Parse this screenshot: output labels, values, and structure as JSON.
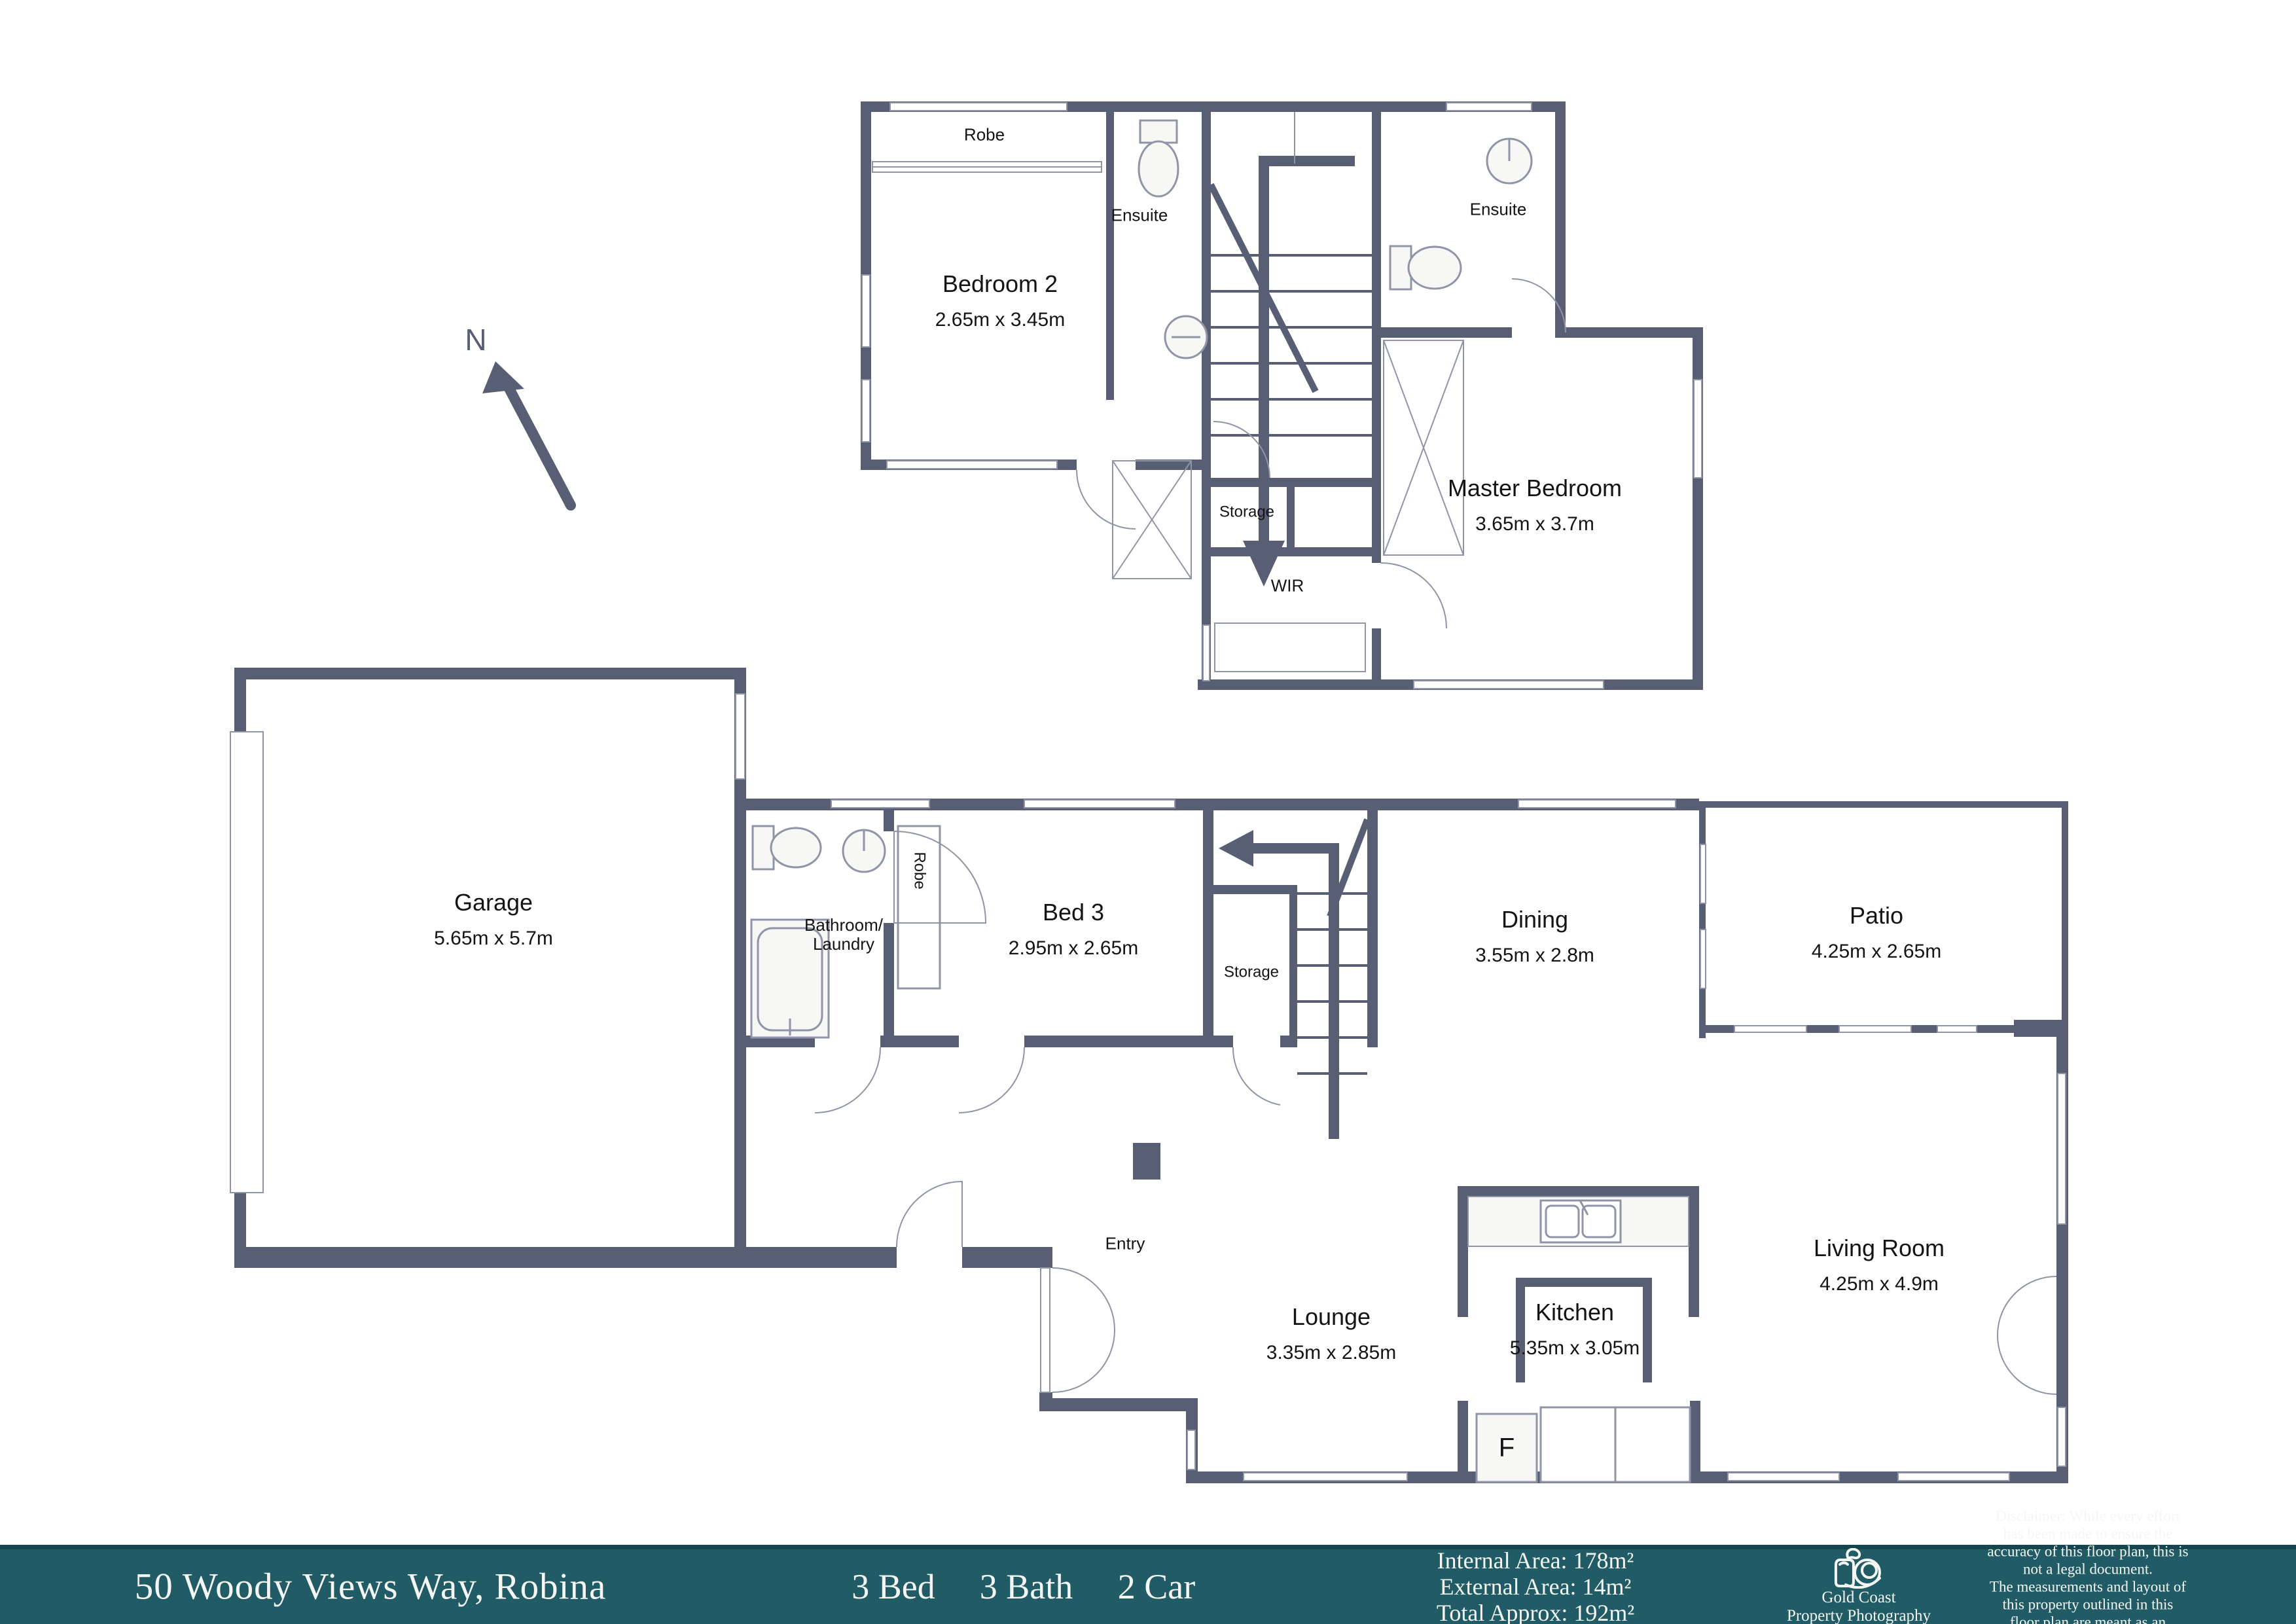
{
  "colors": {
    "wall": "#585e74",
    "thin_line": "#8f94a6",
    "fixture_fill": "#f7f7f5",
    "footer_teal": "#215c66",
    "footer_border": "#16454e",
    "text": "#141414"
  },
  "plan": {
    "north": "N",
    "upper": {
      "robe": "Robe",
      "ensuite_left": "Ensuite",
      "ensuite_right": "Ensuite",
      "bedroom2_name": "Bedroom 2",
      "bedroom2_dims": "2.65m x 3.45m",
      "master_name": "Master Bedroom",
      "master_dims": "3.65m x 3.7m",
      "storage": "Storage",
      "wir": "WIR"
    },
    "lower": {
      "garage_name": "Garage",
      "garage_dims": "5.65m x 5.7m",
      "bathroom_laundry": "Bathroom/\nLaundry",
      "robe": "Robe",
      "bed3_name": "Bed 3",
      "bed3_dims": "2.95m x 2.65m",
      "storage": "Storage",
      "dining_name": "Dining",
      "dining_dims": "3.55m x 2.8m",
      "patio_name": "Patio",
      "patio_dims": "4.25m x 2.65m",
      "entry": "Entry",
      "lounge_name": "Lounge",
      "lounge_dims": "3.35m x 2.85m",
      "kitchen_name": "Kitchen",
      "kitchen_dims": "5.35m x 3.05m",
      "living_name": "Living Room",
      "living_dims": "4.25m x 4.9m",
      "fridge": "F"
    }
  },
  "footer": {
    "address": "50 Woody Views Way, Robina",
    "beds": "3 Bed",
    "baths": "3 Bath",
    "cars": "2 Car",
    "internal_area": "Internal Area: 178m²",
    "external_area": "External Area: 14m²",
    "total_area": "Total Approx: 192m²",
    "logo_name": "Gold Coast\nProperty Photography",
    "disclaimer": "Disclaimer: While every effort has been made to ensure the\naccuracy of this floor plan, this is not a legal document.\nThe measurements and layout of this property outlined in this\nfloor plan are meant as an approximate guide and reference only."
  }
}
